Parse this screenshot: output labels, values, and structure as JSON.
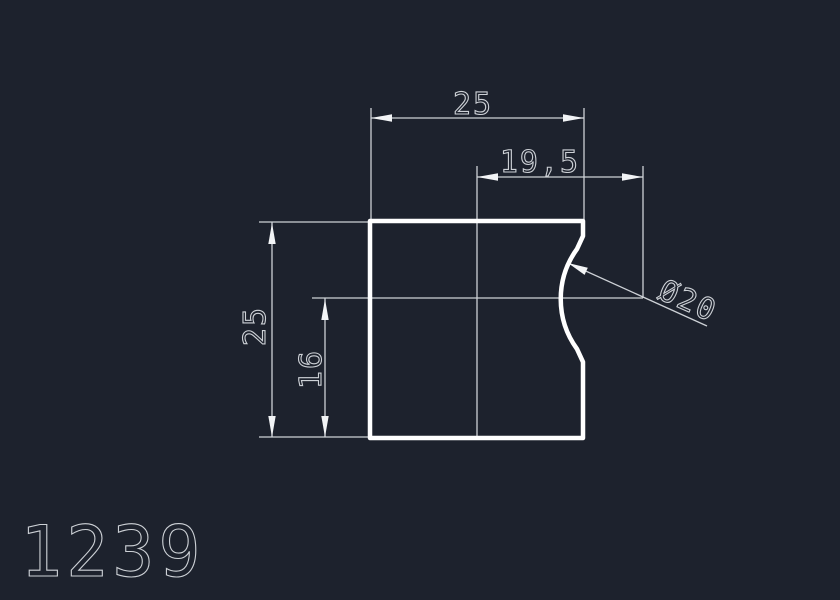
{
  "drawing": {
    "number": "1239",
    "dimensions": {
      "top_width": {
        "label": "25"
      },
      "notch_offset": {
        "label": "19,5"
      },
      "left_height": {
        "label": "25"
      },
      "notch_center_height": {
        "label": "16"
      },
      "notch_diameter": {
        "label": "Ø20"
      }
    },
    "colors": {
      "background": "#1d222d",
      "thin_lines": "#cdd1d6",
      "part_outline": "#ffffff"
    }
  }
}
